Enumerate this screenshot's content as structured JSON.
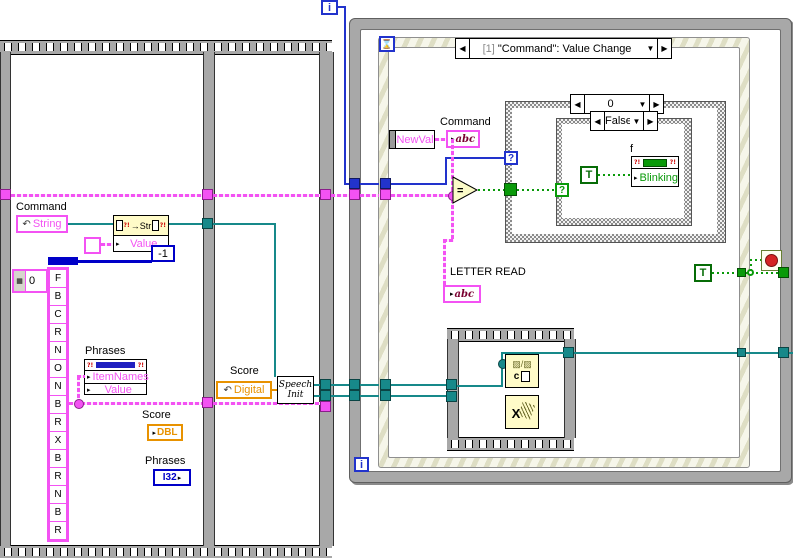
{
  "colors": {
    "pink": "#f352f3",
    "teal": "#17898a",
    "blue": "#2233cc",
    "dark_blue": "#0000c8",
    "orange": "#e89200",
    "green": "#0a9a0a",
    "yellow": "#fffbc8",
    "red": "#d42424"
  },
  "icons": {
    "left_arrow": "◀",
    "right_arrow": "▶",
    "down_arrow": "▼",
    "element_arrow": "▸",
    "hourglass": "⌛",
    "curved_arrow": "↶",
    "method_arrow": "→",
    "hatch": "▨",
    "slash": "/",
    "x_mark": "X",
    "warn": "?!",
    "spinner": "▦",
    "glyph_c": "c"
  },
  "left_sequence": {
    "command_label": "Command",
    "string_terminal": "String",
    "str_node": {
      "method": "Str",
      "row": "Value"
    },
    "minus_one": "-1",
    "array_index": "0",
    "letters": [
      "F",
      "B",
      "C",
      "R",
      "N",
      "O",
      "N",
      "B",
      "R",
      "X",
      "B",
      "R",
      "N",
      "B",
      "R"
    ],
    "phrases_label": "Phrases",
    "phrases_rows": {
      "item_names": "ItemNames",
      "value": "Value"
    },
    "score_label": "Score",
    "score_type": "DBL",
    "phrases2_label": "Phrases",
    "phrases2_type": "I32",
    "score2_label": "Score",
    "digital_terminal": "Digital",
    "speech_init_line1": "Speech",
    "speech_init_line2": "Init"
  },
  "while_loop": {
    "iteration": "i"
  },
  "outer_loop": {
    "iteration": "i"
  },
  "event_structure": {
    "header_index": "[1]",
    "header_title": "\"Command\": Value Change",
    "newval": "NewVal",
    "command_local_label": "Command",
    "abc": "abc",
    "letter_read_label": "LETTER READ",
    "equals": "=",
    "outer_case": {
      "selector": "0",
      "selector_terminal": "?"
    },
    "inner_case": {
      "selector": "False",
      "selector_terminal": "?",
      "true_constant": "T",
      "f_label": "f",
      "blinking_row": "Blinking"
    },
    "stop_true_constant": "T"
  }
}
